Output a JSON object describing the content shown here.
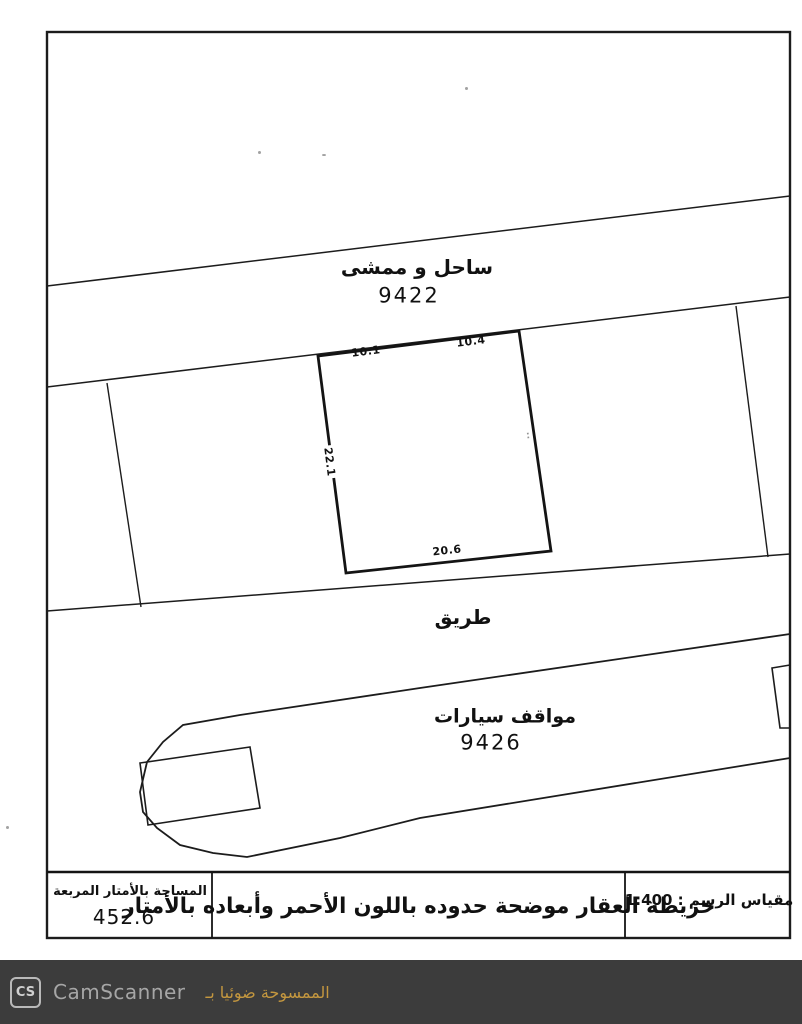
{
  "map": {
    "coast": {
      "name": "ساحل و ممشى",
      "number": "9422"
    },
    "road": {
      "name": "طريق"
    },
    "parking": {
      "name": "مواقف سيارات",
      "number": "9426"
    },
    "plot_dimensions": {
      "top_left": "10.1",
      "top_right": "10.4",
      "left": "22.1",
      "bottom": "20.6",
      "right_faint": "⋅⋅"
    }
  },
  "info_table": {
    "area": {
      "label": "المساحة بالأمتار المربعة",
      "value": "452.6"
    },
    "description": "خريطة العقار موضحة حدوده باللون الأحمر وأبعاده بالأمتار",
    "scale": "مقياس الرسم : 1:400"
  },
  "footer": {
    "logo": "CS",
    "app_name": "CamScanner",
    "scanned_with_text": "الممسوحة ضوئيا بـ"
  },
  "colors": {
    "line": "#1c1c1c",
    "footer_bg": "#3c3c3c",
    "footer_accent": "#c4973f"
  }
}
